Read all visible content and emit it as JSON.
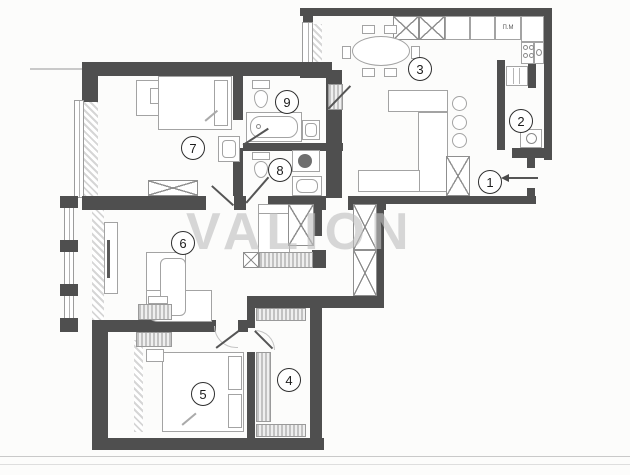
{
  "watermark": {
    "text": "VALION"
  },
  "plan": {
    "room_numbers": [
      "1",
      "2",
      "3",
      "4",
      "5",
      "6",
      "7",
      "8",
      "9"
    ],
    "kitchen_label": "П.М"
  },
  "colors": {
    "wall": "#4f4f4f",
    "furniture_line": "#a3a3a3",
    "watermark": "#c0c0c0",
    "background": "#fcfcfb"
  }
}
